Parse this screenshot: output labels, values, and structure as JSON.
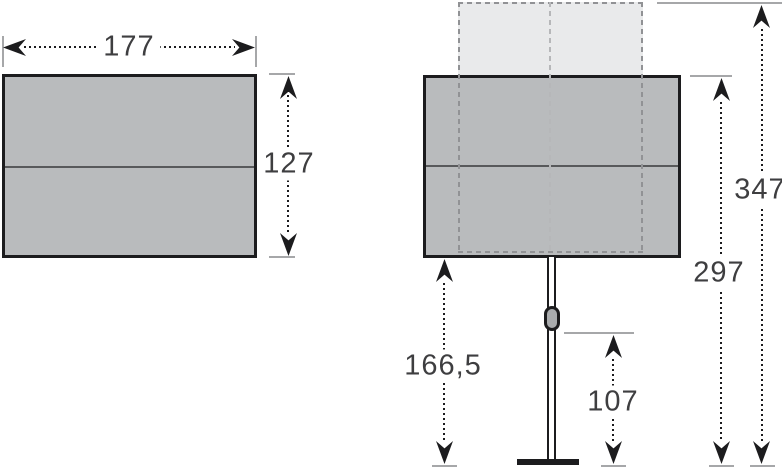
{
  "diagram": {
    "type": "parasol-dimension-drawing",
    "views": {
      "left": "canopy-top-view",
      "right": "parasol-side-view"
    }
  },
  "top_view": {
    "width": {
      "label": "177"
    },
    "height": {
      "label": "127"
    }
  },
  "side_view": {
    "height_max": {
      "label": "347"
    },
    "height_canopy_top": {
      "label": "297"
    },
    "clearance": {
      "label": "166,5"
    },
    "handle_height": {
      "label": "107"
    }
  },
  "colors": {
    "canopy_fill": "#b9bbbd",
    "canopy_border": "#1c1c1e",
    "canopy_seam": "#58595b",
    "ghost_fill": "#e9eaeb",
    "ghost_dash": "#919295",
    "ghost_center_dash": "#b6b7b9",
    "tick": "#a6a7a9",
    "arrow": "#1c1c1e",
    "label_text": "#3e3e40",
    "background": "#ffffff"
  }
}
